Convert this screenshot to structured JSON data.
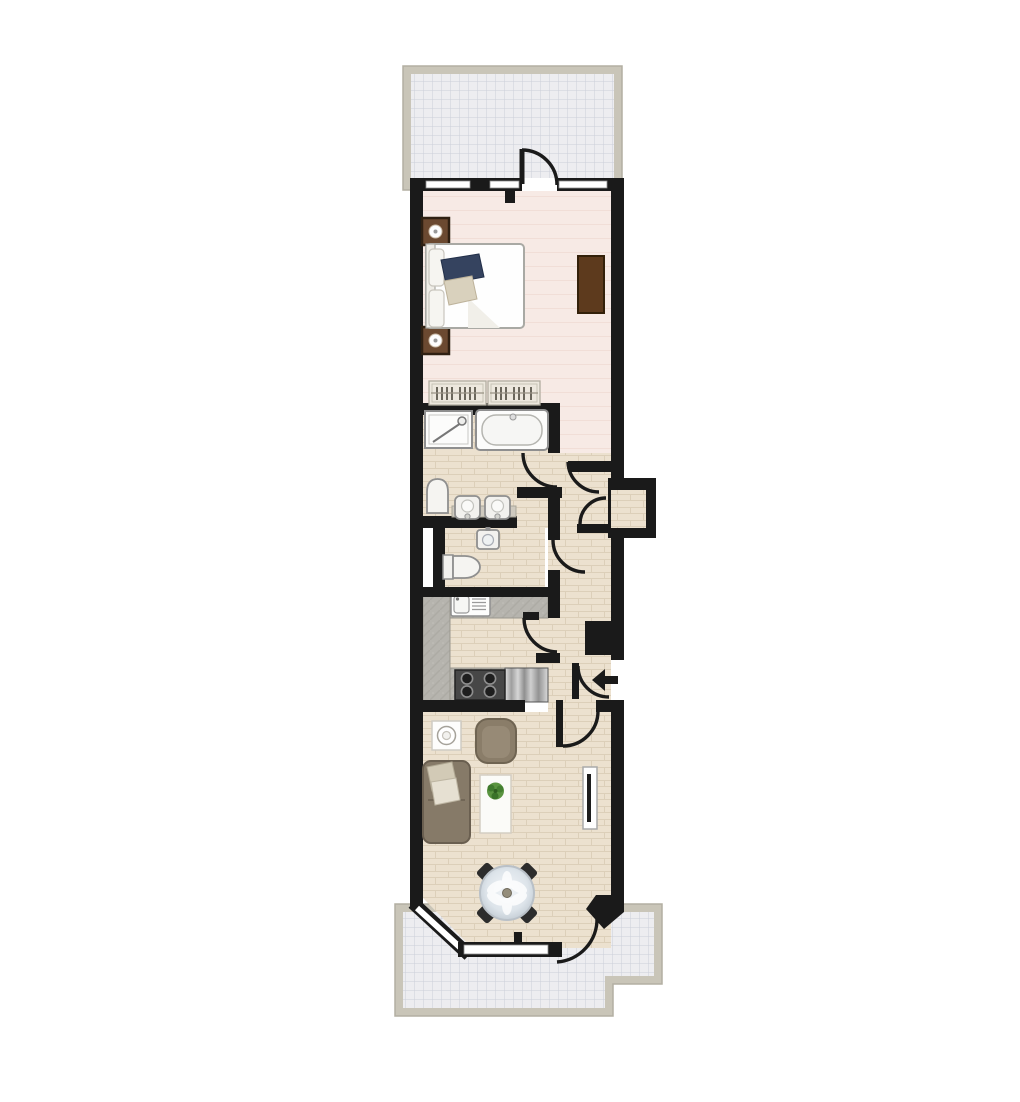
{
  "image": {
    "kind": "floor-plan",
    "visible_text": [],
    "plan": {
      "areas": [
        {
          "name": "terrace-top",
          "finish": "paved-grid"
        },
        {
          "name": "bedroom",
          "finish": "carpet-pink"
        },
        {
          "name": "wardrobe-rails",
          "finish": "built-in"
        },
        {
          "name": "bathroom",
          "finish": "tile"
        },
        {
          "name": "wc",
          "finish": "tile"
        },
        {
          "name": "kitchen",
          "finish": "tile-with-worktops"
        },
        {
          "name": "hallway",
          "finish": "tile"
        },
        {
          "name": "storage-cupboard",
          "finish": "tile"
        },
        {
          "name": "living-dining-room",
          "finish": "tile"
        },
        {
          "name": "terrace-bottom",
          "finish": "paved-grid"
        }
      ],
      "fixtures": [
        "double-bed",
        "nightstand-with-lamp",
        "nightstand-with-lamp",
        "wardrobe",
        "clothes-rail",
        "clothes-rail",
        "shower-tray",
        "bathtub",
        "toilet",
        "basin",
        "basin",
        "wc-basin",
        "wc-toilet",
        "kitchen-sink-drainer",
        "four-ring-hob",
        "stainless-worktop",
        "side-table-lamp",
        "armchair",
        "sofa-with-cushions",
        "coffee-table-with-plant",
        "tv-unit",
        "round-dining-table",
        "dining-chair",
        "dining-chair",
        "dining-chair",
        "dining-chair",
        "bay-window",
        "entrance-arrow"
      ],
      "door_swings": 9,
      "windows": [
        "bedroom-top-left",
        "bedroom-top-right",
        "bay-window-angled",
        "bay-window-front"
      ]
    }
  },
  "colors": {
    "paper": "#ffffff",
    "wall": "#1a1a1a",
    "floorPink": "#f7eae5",
    "floorTile": "#ece1cf",
    "tileLine": "#dccfb9",
    "counter": "#b6b4ae",
    "terraceBg": "#ededf0",
    "terraceLine": "#cbced9",
    "band": "#c9c5b8",
    "bandEdge": "#b3afa2",
    "fixtureStroke": "#8f8f8f",
    "fixtureFill": "#f7f6f3",
    "woodDark": "#6b4930",
    "woodTrim": "#2f2012",
    "wardrobe": "#5d3a1d",
    "sofa": "#867a68",
    "armchair": "#8a7d69",
    "pillowA": "#d2cab6",
    "pillowB": "#e6e0d2",
    "navy": "#35435f",
    "throw": "#d9d1bd",
    "plant": "#4f8a38",
    "chair": "#2c2c2c"
  }
}
